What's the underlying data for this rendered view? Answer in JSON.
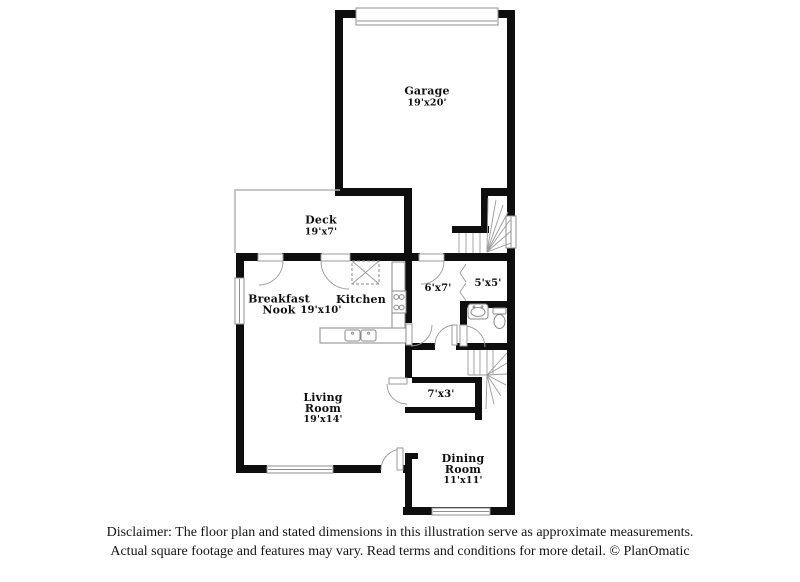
{
  "rooms": {
    "garage": {
      "name": "Garage",
      "dims": "19'x20'"
    },
    "deck": {
      "name": "Deck",
      "dims": "19'x7'"
    },
    "breakfast_nook": {
      "name": "Breakfast Nook"
    },
    "kitchen": {
      "name": "Kitchen",
      "dims": "19'x10'"
    },
    "entry_hall": {
      "dims": "6'x7'"
    },
    "closet": {
      "dims": "5'x5'"
    },
    "living_room": {
      "name": "Living Room",
      "dims": "19'x14'"
    },
    "hallway": {
      "dims": "7'x3'"
    },
    "dining_room": {
      "name": "Dining Room",
      "dims": "11'x11'"
    }
  },
  "disclaimer": {
    "line1": "Disclaimer: The floor plan and stated dimensions in this illustration serve as approximate measurements.",
    "line2": "Actual square footage and features may vary. Read terms and conditions for more detail. © PlanOmatic"
  },
  "colors": {
    "wall": "#0e0e0e",
    "window_stroke": "#8f8f8f",
    "door_stroke": "#9a9a9a",
    "fixture_stroke": "#8a8a8a",
    "stair_stroke": "#9a9a9a",
    "label": "#101010",
    "background": "#ffffff"
  }
}
